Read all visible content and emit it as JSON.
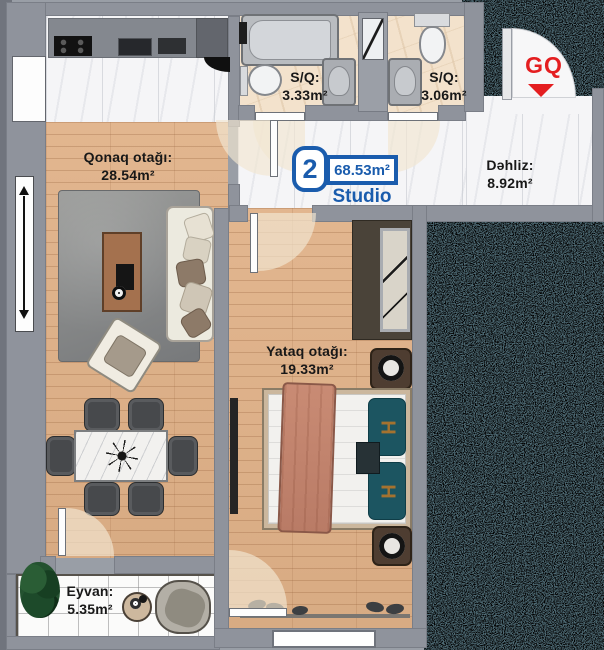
{
  "unit": {
    "number": "2",
    "total_area": "68.53m²",
    "type": "Studio"
  },
  "brand": {
    "logo_text": "GQ"
  },
  "rooms": {
    "living": {
      "name": "Qonaq otağı:",
      "area": "28.54m²"
    },
    "bathroom1": {
      "name": "S/Q:",
      "area": "3.33m²"
    },
    "bathroom2": {
      "name": "S/Q:",
      "area": "3.06m²"
    },
    "hallway": {
      "name": "Dəhliz:",
      "area": "8.92m²"
    },
    "bedroom": {
      "name": "Yataq otağı:",
      "area": "19.33m²"
    },
    "balcony": {
      "name": "Eyvan:",
      "area": "5.35m²"
    }
  },
  "decor": {
    "pillow_monogram": "H"
  },
  "colors": {
    "accent_blue": "#1a5cad",
    "logo_red": "#e41e20",
    "wall_gray": "#8f939c",
    "outside_teal": "#4e6a74",
    "wood_floor": "#ddb28b",
    "marble_floor": "#f5f5f7",
    "bath_tile": "#f3e2cc"
  }
}
